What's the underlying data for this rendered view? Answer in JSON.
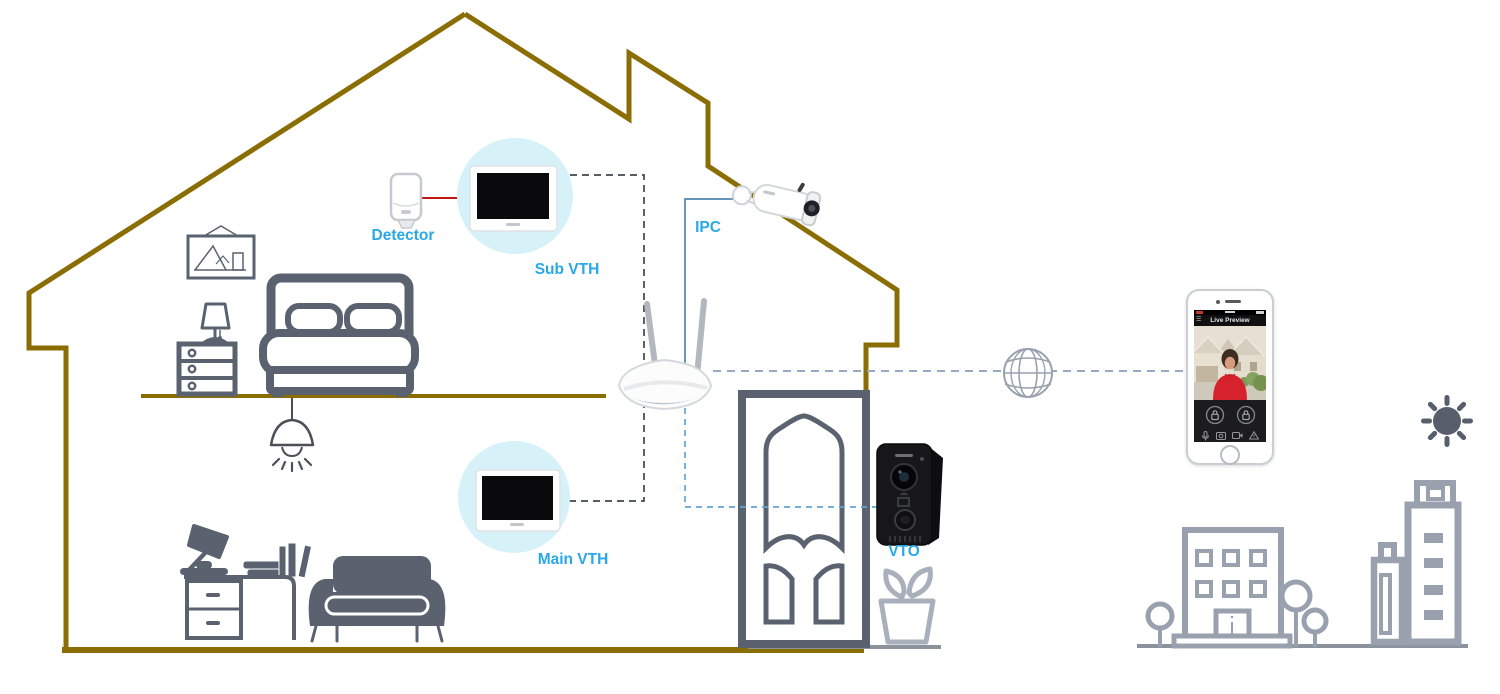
{
  "diagram": {
    "labels": {
      "detector": "Detector",
      "sub_vth": "Sub VTH",
      "ipc": "IPC",
      "main_vth": "Main VTH",
      "vto": "VTO"
    },
    "phone": {
      "app_title": "Live Preview"
    }
  },
  "colors": {
    "house_outline": "#8a6e04",
    "label_blue": "#29a8e8",
    "furniture_gray": "#5a6270",
    "building_gray": "#99a1af",
    "plant_gray": "#a9b0bc",
    "highlight_circle": "#d6f2f8",
    "dark_dashed": "#41454e",
    "blue_dashed": "#62a5d2",
    "internet_dashed": "#95aac2",
    "ipc_line": "#4e86ac",
    "detector_line_red": "#c41414",
    "vto_black": "#17171a",
    "phone_accent_red": "#d6222c"
  }
}
